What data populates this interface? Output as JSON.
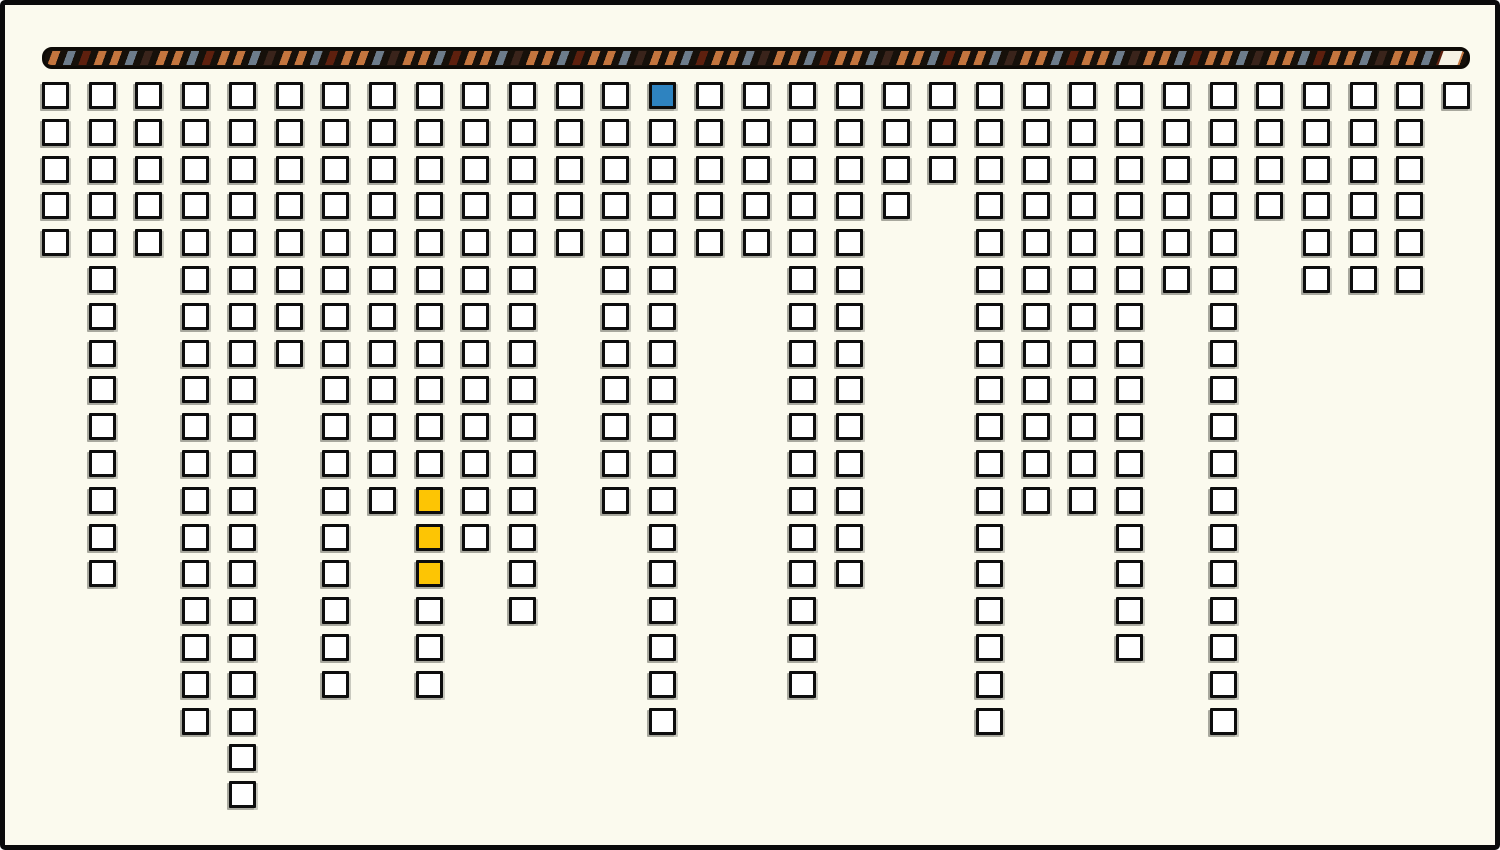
{
  "canvas": {
    "width": 1500,
    "height": 850,
    "background": "#fbfaee",
    "border_color": "#0a0a0a"
  },
  "rope": {
    "background": "#16100a",
    "outline_color": "#0d0a06",
    "stripe_gap_color": "#16100a",
    "stripe_pattern": [
      "#c4753e",
      "#6d7c8b",
      "#5e200e",
      "#c4753e",
      "#c4753e",
      "#6d7c8b",
      "#3a241b",
      "#c4753e"
    ],
    "end_segment_color": "#f6f2e4"
  },
  "cells": {
    "fill": "#ffffff",
    "border_color": "#0d0d0d",
    "shadow_color": "#a8a89e"
  },
  "chart_data": {
    "type": "heatmap",
    "description": "31 columns of outlined square cells hang below a diagonally striped rope bar; each column is a contiguous run of cells starting at the top row. One cell is highlighted blue and three consecutive cells in one column are highlighted yellow.",
    "columns": 31,
    "max_rows": 20,
    "cells_per_column": [
      5,
      14,
      5,
      18,
      20,
      8,
      17,
      12,
      17,
      13,
      15,
      5,
      12,
      18,
      5,
      5,
      17,
      14,
      4,
      3,
      18,
      12,
      12,
      16,
      6,
      18,
      4,
      6,
      6,
      6,
      1
    ],
    "total_cells": 332,
    "highlight_colors": {
      "blue": "#2e83c0",
      "yellow": "#fdc504"
    },
    "highlight_cells": [
      {
        "col": 13,
        "row": 0,
        "color": "blue"
      },
      {
        "col": 8,
        "row": 11,
        "color": "yellow"
      },
      {
        "col": 8,
        "row": 12,
        "color": "yellow"
      },
      {
        "col": 8,
        "row": 13,
        "color": "yellow"
      }
    ],
    "legend": "none",
    "axis_labels": "none",
    "title": ""
  }
}
